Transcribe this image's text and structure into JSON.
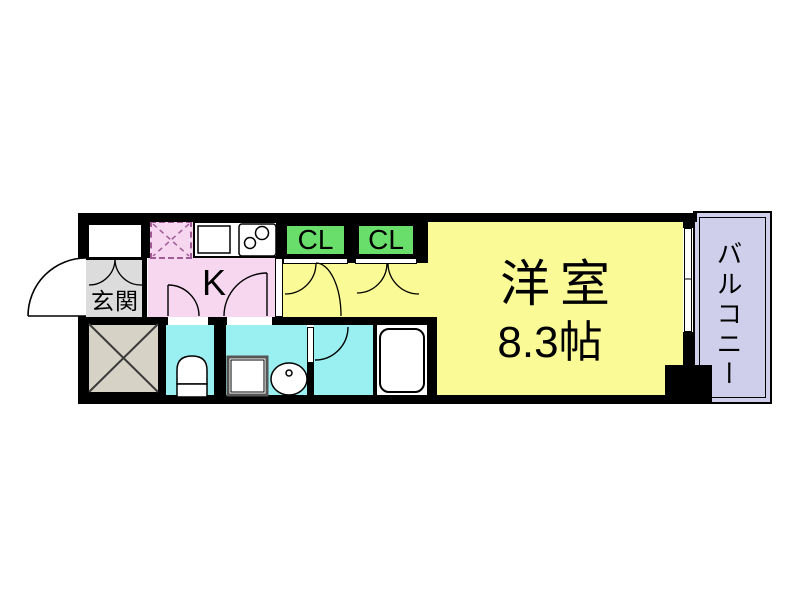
{
  "floorplan": {
    "labels": {
      "entrance": "玄関",
      "kitchen": "K",
      "closet_1": "CL",
      "closet_2": "CL",
      "main_room_name": "洋室",
      "main_room_size": "8.3帖",
      "balcony": "バルコニー"
    },
    "colors": {
      "main_room": "#fafa96",
      "kitchen": "#f7d7f0",
      "closet": "#6ade6a",
      "wet_area": "#9af0f0",
      "balcony": "#cfcfec",
      "entrance": "#dcdcdc",
      "shaft": "#d6d2c6",
      "wall": "#000000",
      "refrigerator_dash": "#a05a96"
    }
  }
}
